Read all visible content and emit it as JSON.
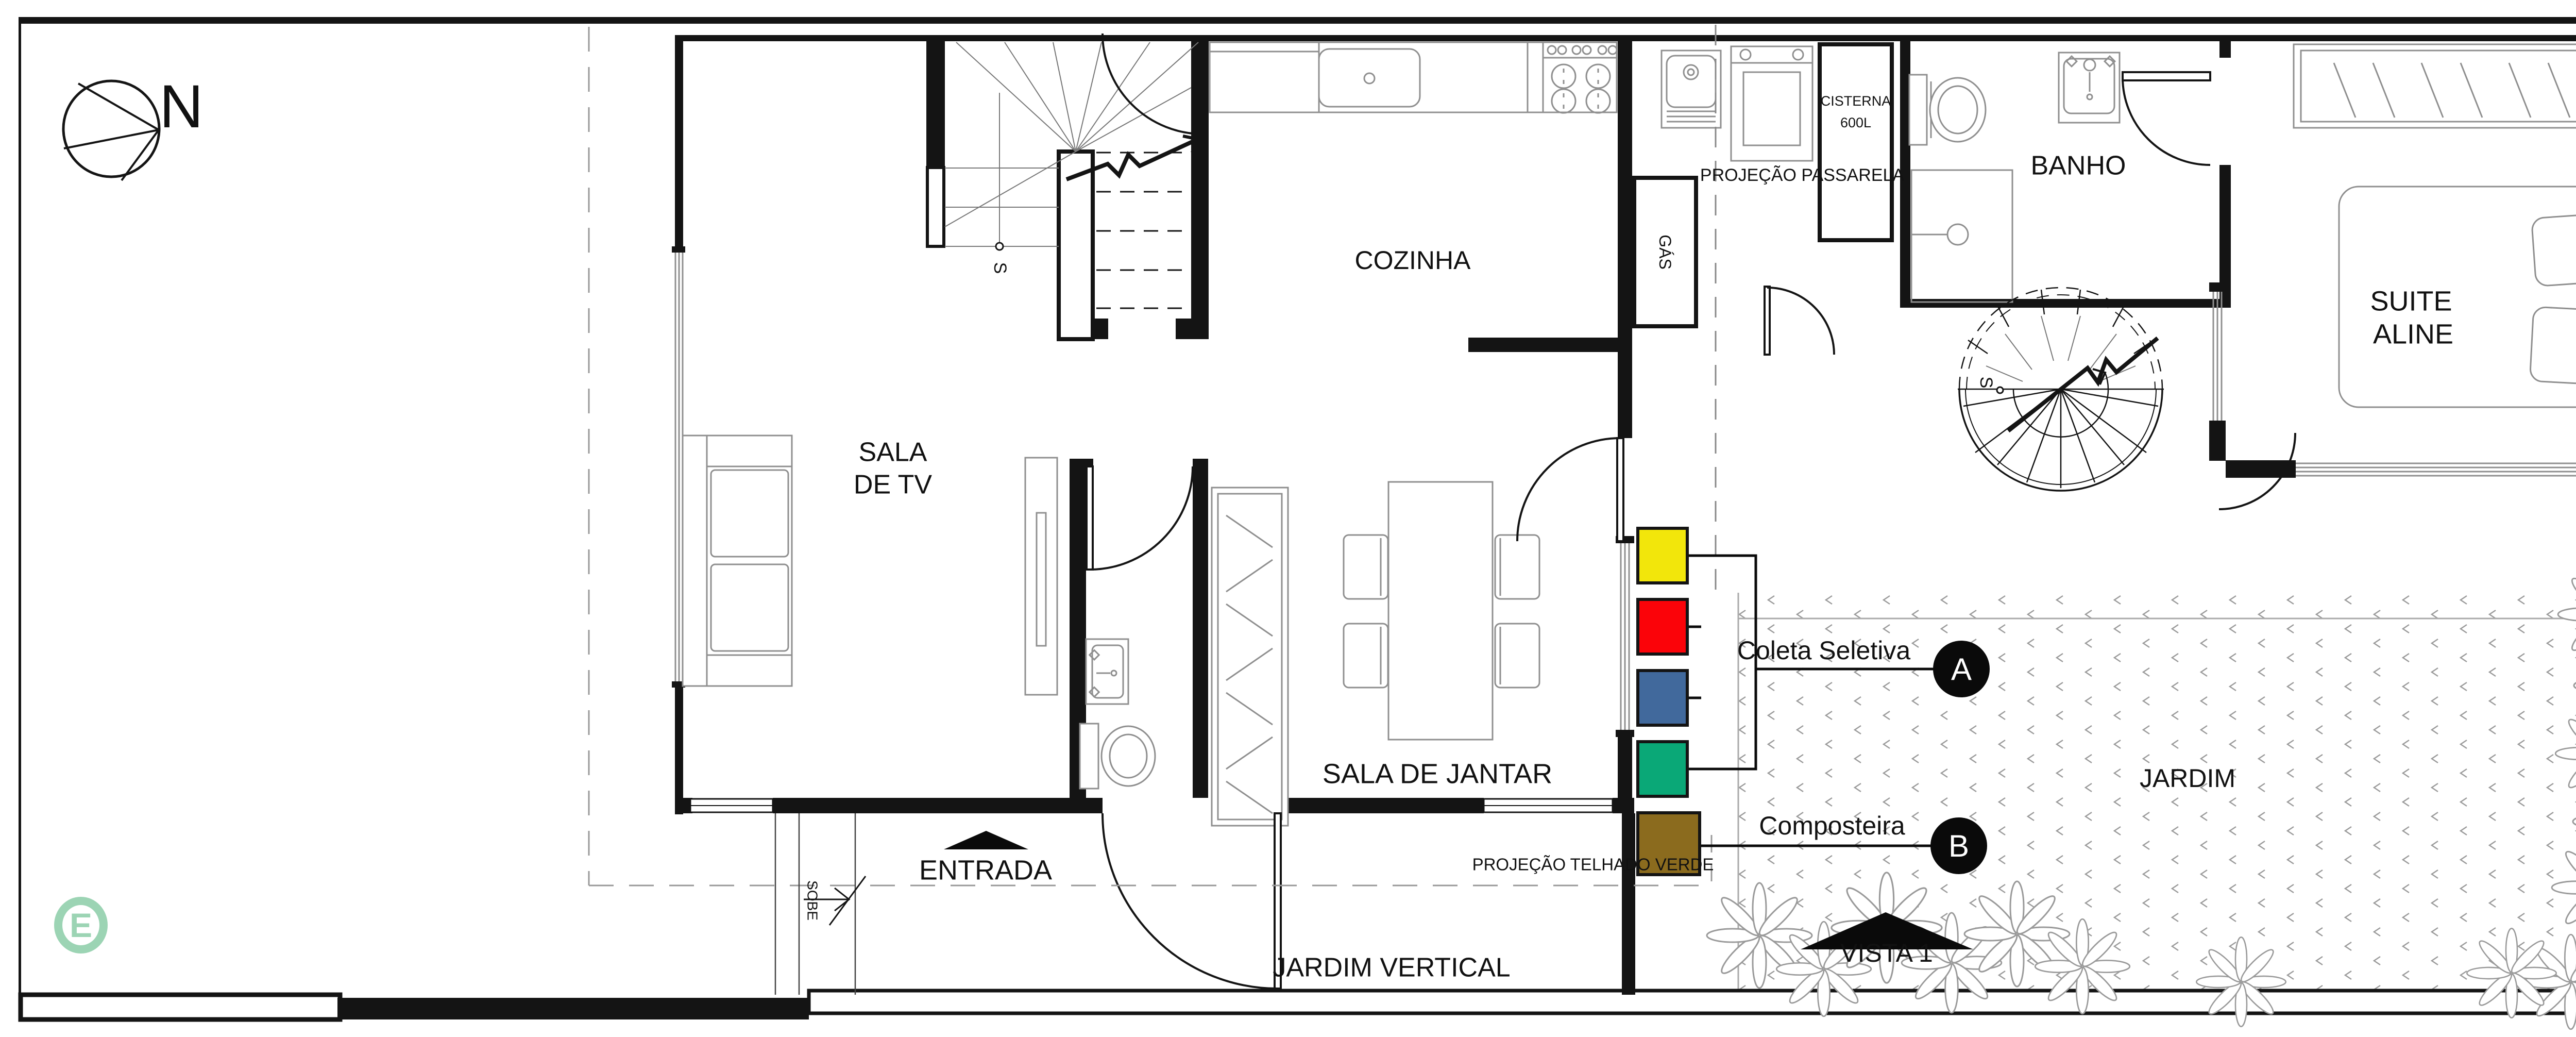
{
  "compass": {
    "label": "N"
  },
  "logo": {
    "letter": "E"
  },
  "rooms": {
    "cozinha": "COZINHA",
    "banho": "BANHO",
    "suite1": "SUITE",
    "suite2": "ALINE",
    "sala_tv1": "SALA",
    "sala_tv2": "DE TV",
    "sala_jantar": "SALA DE JANTAR",
    "jardim": "JARDIM"
  },
  "stairs": {
    "main_s": "S",
    "spiral_s": "S",
    "sobe": "SOBE"
  },
  "service": {
    "gas": "GÁS",
    "cisterna1": "CISTERNA",
    "cisterna2": "600L"
  },
  "projections": {
    "passarela": "PROJEÇÃO PASSARELA",
    "telhado_verde": "PROJEÇÃO TELHADO VERDE"
  },
  "entrance": {
    "label": "ENTRADA"
  },
  "garden": {
    "jardim_vertical": "JARDIM VERTICAL",
    "vista": "VISTA 1"
  },
  "legend": {
    "coleta": {
      "label": "Coleta Seletiva",
      "tag": "A"
    },
    "composteira": {
      "label": "Composteira",
      "tag": "B"
    },
    "bins": [
      {
        "name": "recycle-bin-yellow",
        "color": "#F2E60B"
      },
      {
        "name": "recycle-bin-red",
        "color": "#FB0309"
      },
      {
        "name": "recycle-bin-blue",
        "color": "#41699C"
      },
      {
        "name": "recycle-bin-green",
        "color": "#0AA877"
      },
      {
        "name": "compost-bin-brown",
        "color": "#8B6B1E"
      }
    ]
  },
  "colors": {
    "wall": "#141414",
    "furniture": "#8f8f8f",
    "plants": "#9a9a9a",
    "logo": "#9cd4b4"
  }
}
